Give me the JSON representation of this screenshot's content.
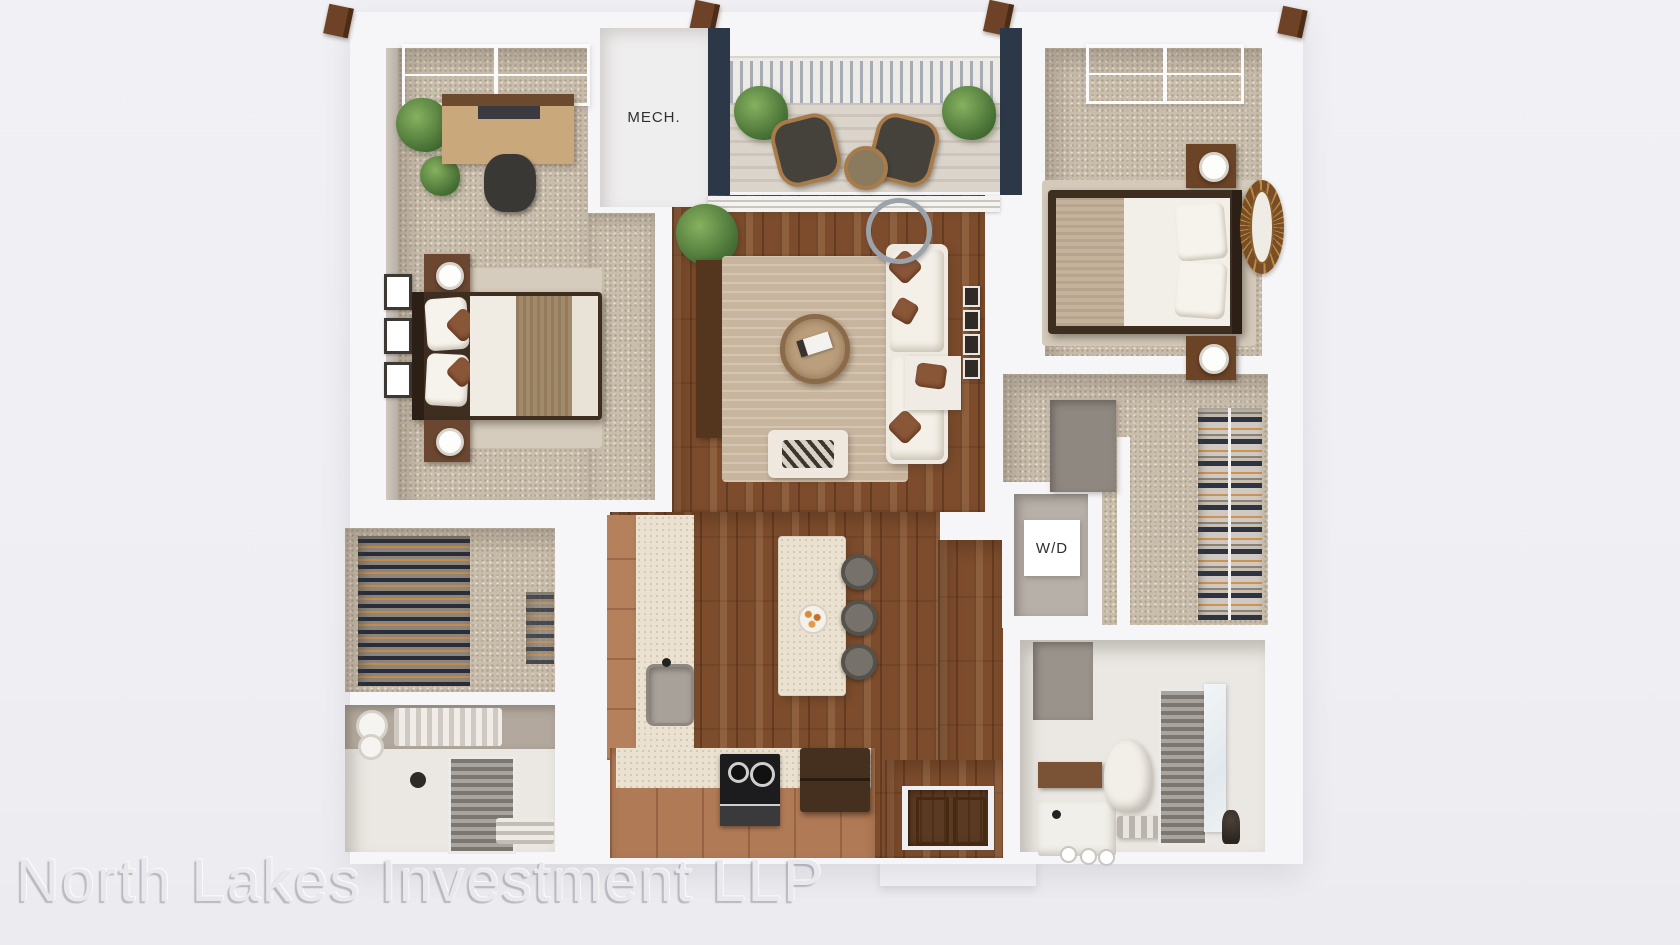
{
  "labels": {
    "mech": "MECH.",
    "washer_dryer": "W/D"
  },
  "watermark": {
    "text": "North Lakes Investment LLP",
    "color": "#e9e8ec"
  },
  "palette": {
    "background": "#f0f0f4",
    "wall_white": "#f6f5f7",
    "carpet_beige": "#c9bdac",
    "wood_floor_brown": "#7c4c2c",
    "balcony_deck": "#d8d1c7",
    "accent_navy_wall": "#2c3748",
    "cabinet_clay": "#b5805c",
    "counter_cream": "#eae1d0",
    "furniture_dark_brown": "#3e2e20",
    "plant_green": "#4a7437",
    "label_text": "#2f2f31"
  }
}
